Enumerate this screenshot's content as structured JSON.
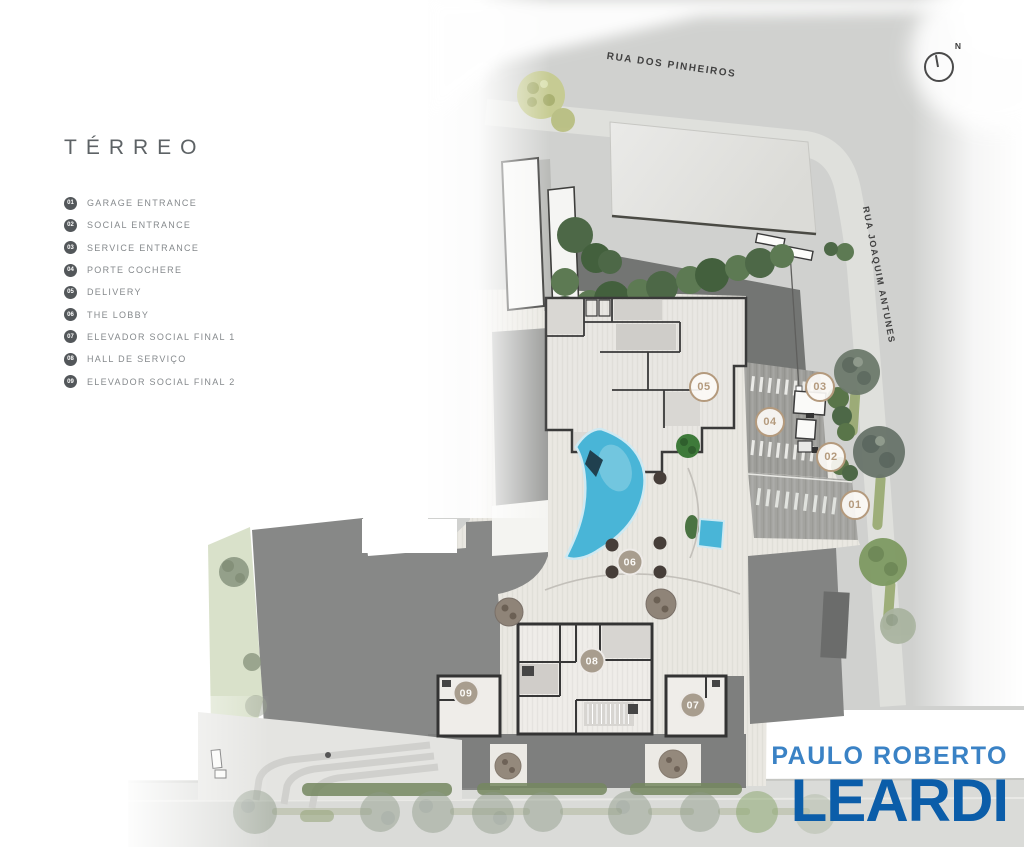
{
  "page": {
    "background": "#ffffff",
    "width": 1024,
    "height": 847
  },
  "legend": {
    "title": "TÉRREO",
    "items": [
      {
        "num": "01",
        "label": "GARAGE ENTRANCE"
      },
      {
        "num": "02",
        "label": "SOCIAL ENTRANCE"
      },
      {
        "num": "03",
        "label": "SERVICE ENTRANCE"
      },
      {
        "num": "04",
        "label": "PORTE COCHERE"
      },
      {
        "num": "05",
        "label": "DELIVERY"
      },
      {
        "num": "06",
        "label": "THE LOBBY"
      },
      {
        "num": "07",
        "label": "ELEVADOR SOCIAL FINAL 1"
      },
      {
        "num": "08",
        "label": "HALL DE SERVIÇO"
      },
      {
        "num": "09",
        "label": "ELEVADOR SOCIAL FINAL 2"
      }
    ]
  },
  "plan": {
    "streets": {
      "top": "RUA DOS PINHEIROS",
      "right": "RUA JOAQUIM ANTUNES"
    },
    "compass": {
      "label": "N"
    },
    "markers": [
      {
        "num": "01",
        "x": 855,
        "y": 505,
        "style": "outline"
      },
      {
        "num": "02",
        "x": 831,
        "y": 457,
        "style": "outline"
      },
      {
        "num": "03",
        "x": 820,
        "y": 387,
        "style": "outline"
      },
      {
        "num": "04",
        "x": 770,
        "y": 422,
        "style": "outline"
      },
      {
        "num": "05",
        "x": 704,
        "y": 387,
        "style": "outline"
      },
      {
        "num": "06",
        "x": 630,
        "y": 562,
        "style": "filled"
      },
      {
        "num": "07",
        "x": 693,
        "y": 705,
        "style": "filled"
      },
      {
        "num": "08",
        "x": 592,
        "y": 661,
        "style": "filled"
      },
      {
        "num": "09",
        "x": 466,
        "y": 693,
        "style": "filled"
      }
    ]
  },
  "logo": {
    "line1": "PAULO ROBERTO",
    "line2": "LEARDI"
  },
  "colors": {
    "accent_tan": "#b49a7d",
    "legend_badge": "#53575a",
    "legend_text": "#85898c",
    "logo_light_blue": "#3a82c5",
    "logo_blue": "#0b5da9",
    "pool_blue": "#49b5d7",
    "street_gray": "#d0d1cf",
    "mass_gray": "#878887",
    "wall_dark": "#383838"
  }
}
